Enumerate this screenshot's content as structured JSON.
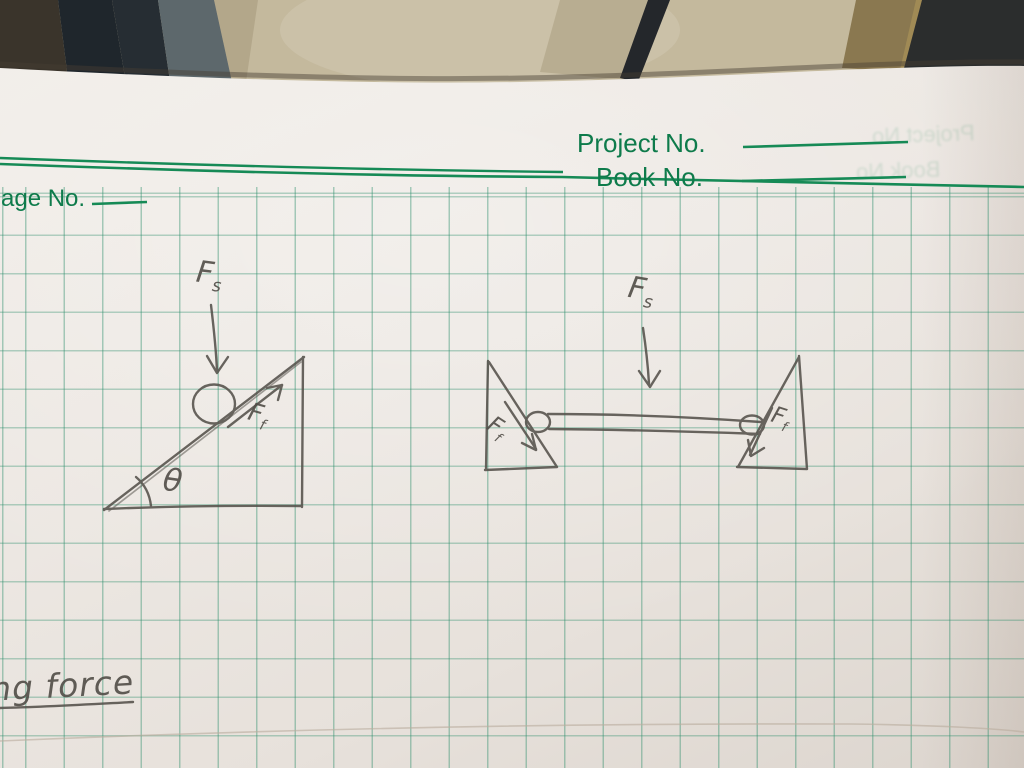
{
  "notebook": {
    "header": {
      "project_label": "Project No.",
      "book_label": "Book No.",
      "page_label": "age No.",
      "ghost_project_label": "Project No",
      "ghost_book_label": "Book No"
    },
    "caption": "ng force",
    "diagrams": {
      "left_incline": {
        "description": "ball resting on inclined plane",
        "spring_force": {
          "symbol": "F",
          "subscript": "s"
        },
        "friction_force": {
          "symbol": "F",
          "subscript": "f"
        },
        "angle_symbol": "θ"
      },
      "right_fixture": {
        "description": "bar resting on rollers between two opposing inclines",
        "spring_force": {
          "symbol": "F",
          "subscript": "s"
        },
        "friction_force_left": {
          "symbol": "F",
          "subscript": "f"
        },
        "friction_force_right": {
          "symbol": "F",
          "subscript": "f"
        }
      }
    },
    "colors": {
      "print_green": "#0e7b4b",
      "grid_green": "#2b8d6a",
      "pencil_gray": "#54504a",
      "paper": "#ebe6e1",
      "floor_tan": "#c4b99d"
    }
  }
}
